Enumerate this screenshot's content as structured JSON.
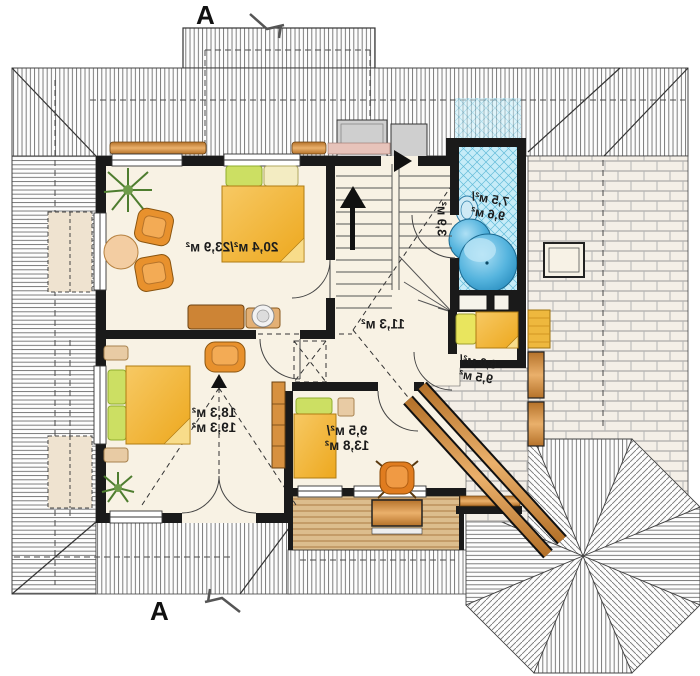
{
  "title": "Upper floor plan (mirrored)",
  "markers": {
    "top": "A",
    "bottom": "A"
  },
  "rooms": {
    "master": {
      "area": "20,4 м²/23,9 м²"
    },
    "hall": {
      "area": "11,3 м²"
    },
    "stairs": {
      "area": "3,9 м²"
    },
    "bath": {
      "line1": "7,5 м²/",
      "line2": "9,6 м²"
    },
    "small": {
      "line1": "6,0 м²/",
      "line2": "9,5 м²"
    },
    "bedroom2": {
      "line1": "18,3 м²",
      "line2": "19,3 м²"
    },
    "bedroom3": {
      "line1": "9,5 м²/",
      "line2": "13,8 м²"
    }
  },
  "colors": {
    "wall": "#1a1a1a",
    "floor": "#f8f2e4",
    "wood": "#c9842e",
    "bed": "#f2b437",
    "pillow": "#ccdf63",
    "chair": "#e8912d",
    "tile": "#c6ecf8",
    "tub": "#2f9ccc"
  }
}
